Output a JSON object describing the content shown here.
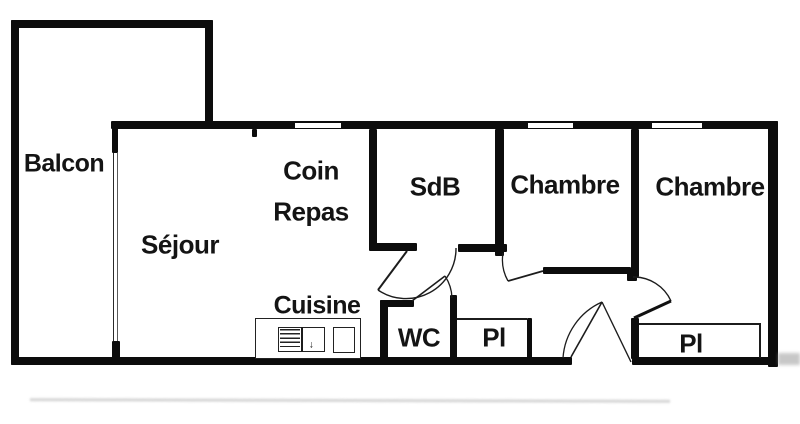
{
  "plan": {
    "type": "apartment-floor-plan",
    "rooms": {
      "balcon": {
        "label": "Balcon"
      },
      "sejour": {
        "label": "Séjour"
      },
      "coin_repas": {
        "line1": "Coin",
        "line2": "Repas"
      },
      "cuisine": {
        "label": "Cuisine"
      },
      "sdb": {
        "label": "SdB"
      },
      "chambre_1": {
        "label": "Chambre"
      },
      "chambre_2": {
        "label": "Chambre"
      },
      "wc": {
        "label": "WC"
      },
      "placard_1": {
        "label": "Pl"
      },
      "placard_2": {
        "label": "Pl"
      }
    },
    "features": {
      "windows": [
        "sejour-balcony-window",
        "coin-repas-window",
        "chambre-1-window",
        "chambre-2-window"
      ],
      "doors": [
        "sdb-door",
        "wc-door",
        "chambre-1-door",
        "chambre-2-door",
        "entry-door"
      ],
      "kitchen_fixtures": [
        "stove-unit",
        "sink-unit"
      ]
    },
    "colors": {
      "wall": "#0c0c0c",
      "text": "#141414",
      "background": "#ffffff"
    }
  }
}
